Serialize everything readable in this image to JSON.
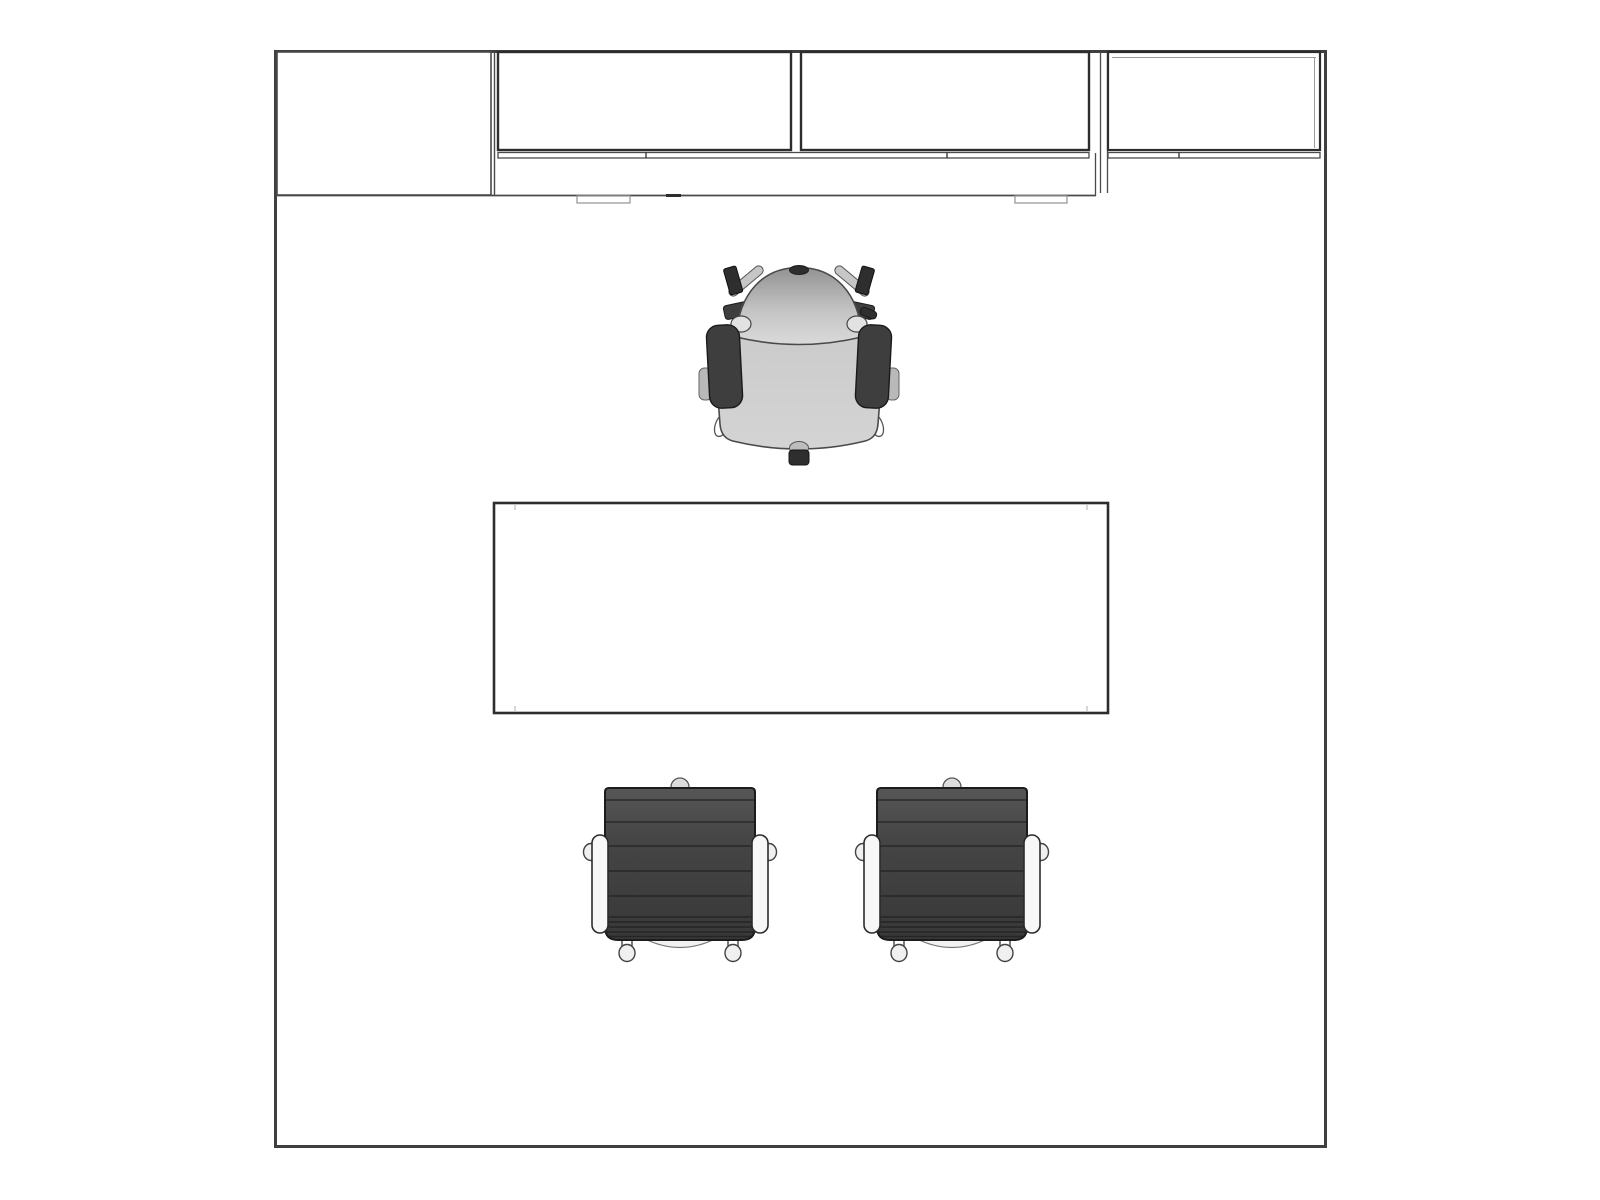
{
  "scene": {
    "title": "private-office-floor-plan-top-view",
    "background": "#ffffff"
  },
  "colors": {
    "wall": "#3f3f3f",
    "line": "#2d2d2d",
    "line_thin": "#4a4a4a",
    "line_light": "#9a9a9a",
    "white": "#ffffff",
    "task_seat": "#cbcbcb",
    "task_back_top": "#929292",
    "task_back_bottom": "#dadada",
    "task_arm_pad": "#3e3e3e",
    "task_dark": "#2e2e2e",
    "task_strut": "#c6c6c6",
    "task_metal_light": "#e2e2e2",
    "guest_body_top": "#565656",
    "guest_body_bottom": "#383838",
    "guest_rib": "#1f1f1f",
    "guest_arm": "#f7f7f7",
    "guest_foot": "#f0f0f0",
    "guest_knob": "#dcdcdc"
  },
  "items": {
    "room": "room-outline",
    "storage_tower": "storage-tower-top-left",
    "upper_cabinet_left": "upper-cabinet-left",
    "upper_cabinet_center": "upper-cabinet-center",
    "upper_shelf_right": "upper-shelf-right",
    "rail": "wall-rail",
    "worksurface": "wall-hung-worksurface",
    "pedestal_pull_left": "drawer-pull-left",
    "pedestal_pull_right": "drawer-pull-right",
    "task_chair": "task-chair-top-view",
    "desk": "desk-top-view",
    "guest_chair_left": "guest-chair-left",
    "guest_chair_right": "guest-chair-right"
  }
}
